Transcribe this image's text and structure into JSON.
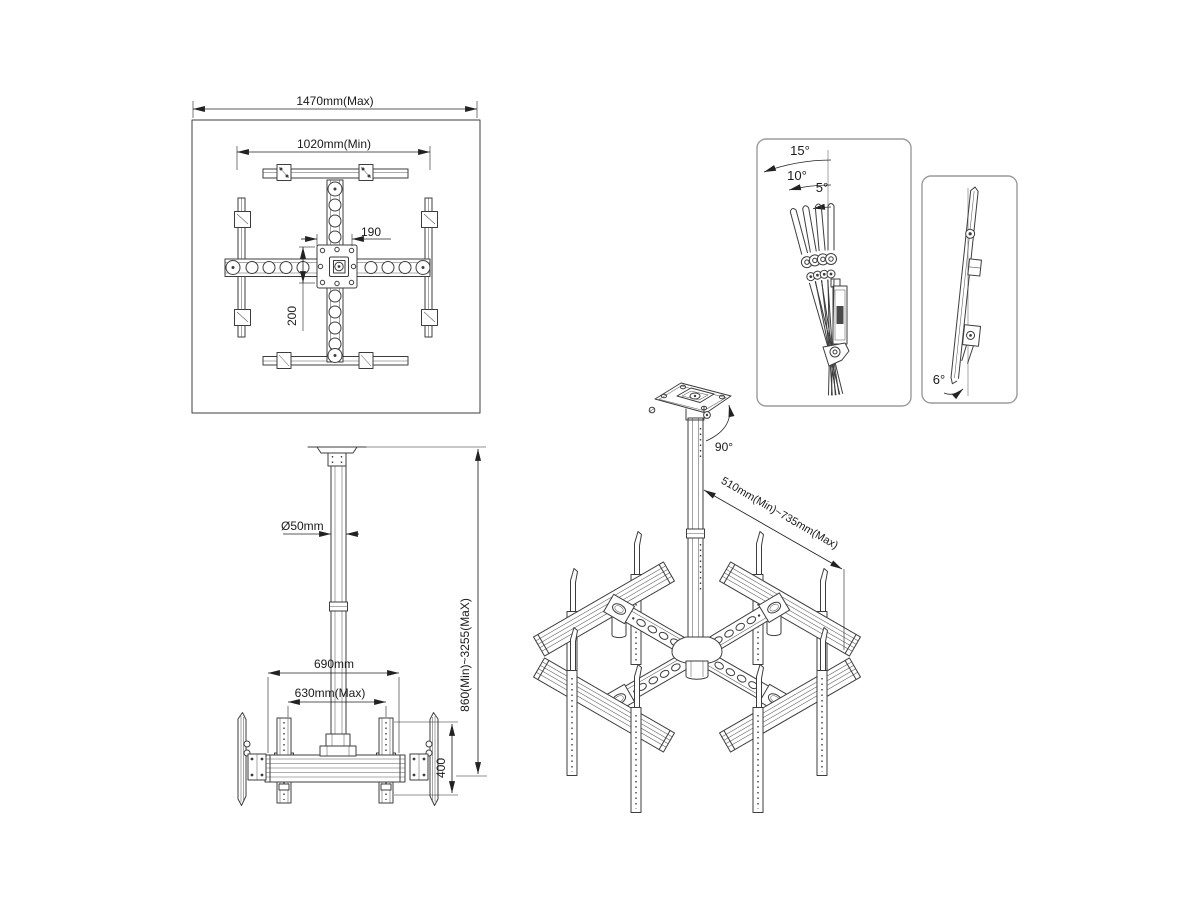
{
  "drawing": {
    "top_view": {
      "dim_width_max": "1470mm(Max)",
      "dim_width_min": "1020mm(Min)",
      "dim_plate_w": "190",
      "dim_plate_h": "200"
    },
    "front_view": {
      "dim_pole": "Ø50mm",
      "dim_beam": "690mm",
      "dim_spread": "630mm(Max)",
      "dim_rail": "400",
      "dim_height": "860(Min)~3255(MaX)"
    },
    "iso_view": {
      "dim_swivel": "90°",
      "dim_column": "510mm(Min)~735mm(Max)"
    },
    "tilt_panel": {
      "a15": "15°",
      "a10": "10°",
      "a5": "5°"
    },
    "side_panel": {
      "a6": "6°"
    }
  },
  "colors": {
    "line": "#3d3d3d",
    "dim": "#222222",
    "text": "#1a1a1a",
    "panel_border": "#9b9b9b",
    "bg": "#ffffff",
    "dark_fill": "#4a4a4a"
  }
}
